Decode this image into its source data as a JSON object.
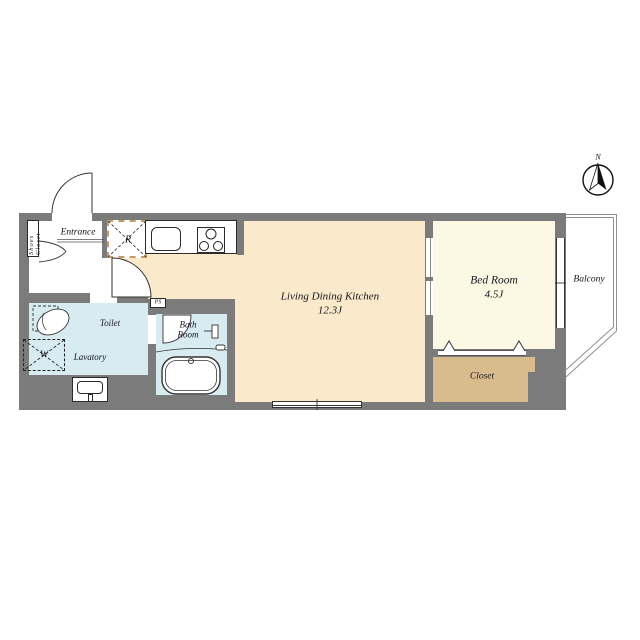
{
  "colors": {
    "wall": "#7b7b7b",
    "ldk_floor": "#fbe9cc",
    "bedroom_floor": "#fcf8e3",
    "wet_floor": "#d8ebf1",
    "closet_floor": "#d9bc8d",
    "r_dash": "#c59a66",
    "text": "#15151e",
    "balcony_line": "#8f8f8f"
  },
  "compass": {
    "north_label": "N"
  },
  "rooms": {
    "entrance": {
      "label": "Entrance"
    },
    "shoes_closet": {
      "label": "Shoes Closet"
    },
    "refrigerator_space": {
      "label": "R"
    },
    "washer_space": {
      "label": "W"
    },
    "pipe_space": {
      "label": "PS"
    },
    "toilet": {
      "label": "Toilet"
    },
    "lavatory": {
      "label": "Lavatory"
    },
    "bath_room": {
      "label_line1": "Bath",
      "label_line2": "Room"
    },
    "ldk": {
      "label": "Living Dining Kitchen",
      "size": "12.3J"
    },
    "bed_room": {
      "label": "Bed Room",
      "size": "4.5J"
    },
    "closet": {
      "label": "Closet"
    },
    "balcony": {
      "label": "Balcony"
    }
  }
}
